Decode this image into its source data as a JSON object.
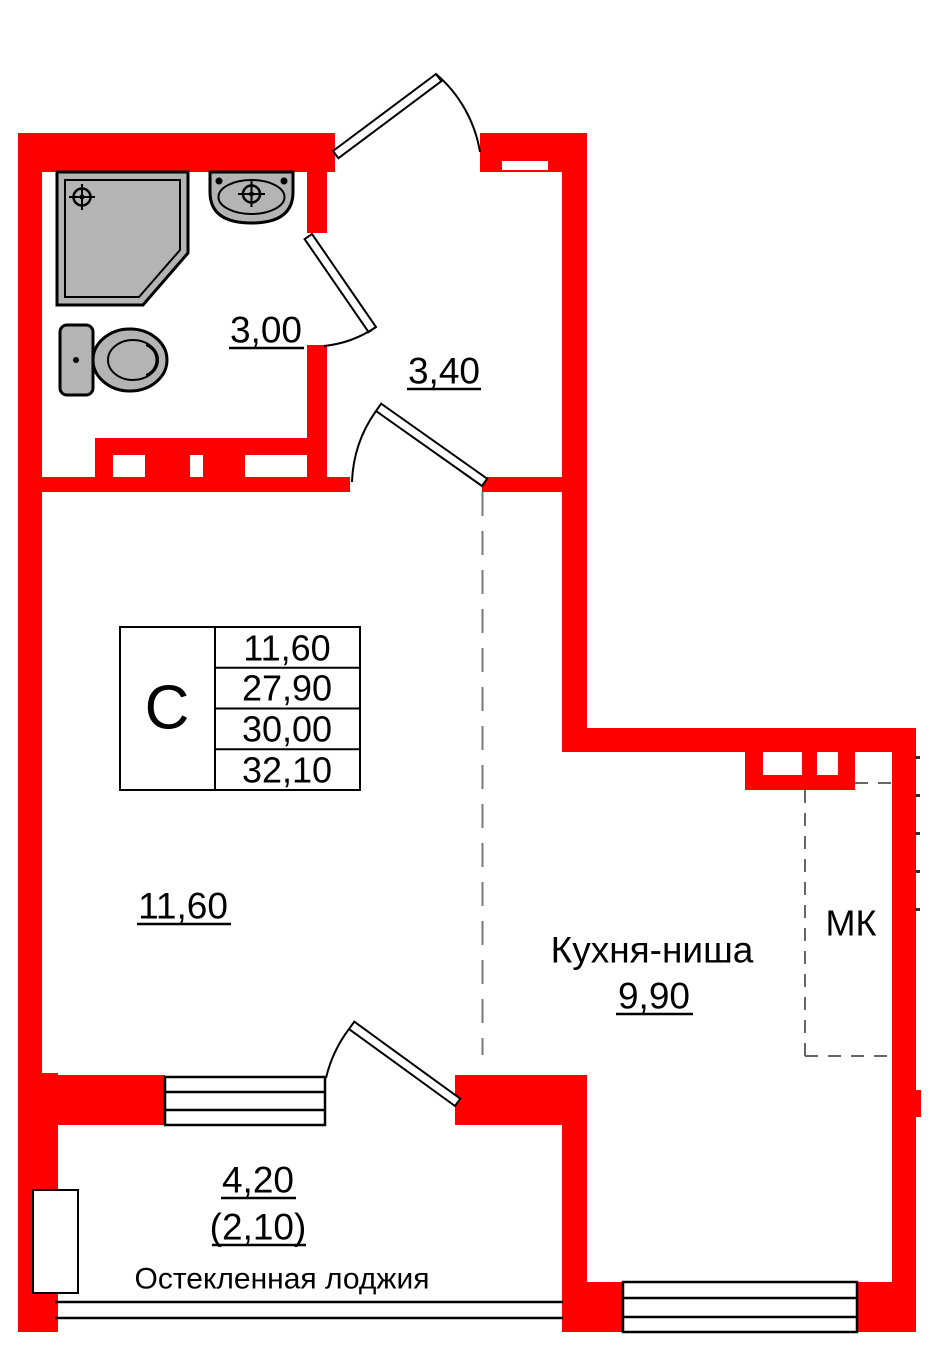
{
  "plan": {
    "colors": {
      "wall": "#fe0000",
      "fixture": "#b4b4b4",
      "dash": "#7a7a7a"
    },
    "labels": {
      "bathroom_area": "3,00",
      "hall_area": "3,40",
      "living_area": "11,60",
      "kitchen_name": "Кухня-ниша",
      "kitchen_area": "9,90",
      "duct": "МК",
      "loggia_area_full": "4,20",
      "loggia_area_reduced": "(2,10)",
      "loggia_name": "Остекленная лоджия"
    },
    "unit_table": {
      "type_label": "С",
      "rows": {
        "living": "11,60",
        "area_no_loggia": "27,90",
        "area_half_loggia": "30,00",
        "area_full": "32,10"
      }
    }
  }
}
